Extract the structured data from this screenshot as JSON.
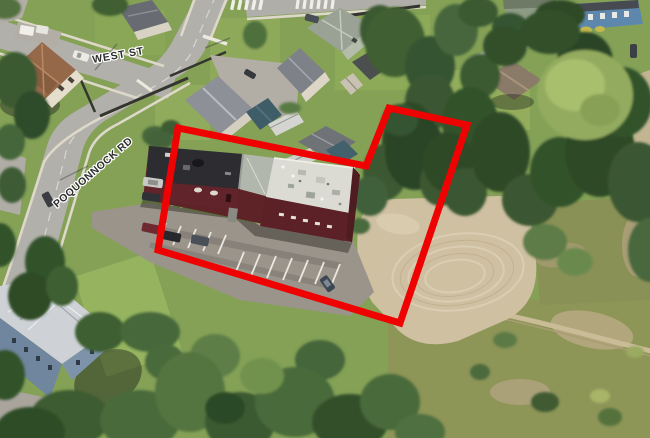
{
  "map": {
    "street_labels": {
      "west_st": "WEST ST",
      "poquonnock_rd": "POQUONNOCK RD"
    },
    "boundary": {
      "color": "#ee0202",
      "stroke_width": "7",
      "points": "178,128 366,166 389,108 467,125 400,323 158,250"
    },
    "label_text_color": "#2d2d2d",
    "label_halo_color": "#ffffff"
  }
}
